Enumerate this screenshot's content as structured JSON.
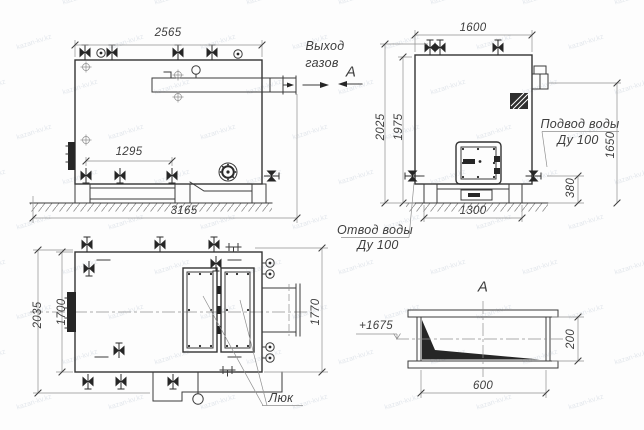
{
  "watermark": {
    "text": "kazan-kv.kz"
  },
  "front_view": {
    "dim_top_width": "2565",
    "dim_drain_spacing": "1295",
    "dim_total_length": "3165",
    "gas_outlet_line1": "Выход",
    "gas_outlet_line2": "газов",
    "section_mark": "А"
  },
  "side_view": {
    "dim_top_width": "1600",
    "dim_total_height": "2025",
    "dim_shell_height": "1975",
    "dim_gas_outlet_height": "1650",
    "dim_water_inlet_height": "380",
    "dim_base_width": "1300",
    "water_inlet_line1": "Подвод воды",
    "water_inlet_line2": "Ду 100",
    "water_outlet_line1": "Отвод воды",
    "water_outlet_line2": "Ду 100"
  },
  "plan_view": {
    "dim_total_width": "2035",
    "dim_shell_width": "1700",
    "dim_right_width": "1770",
    "hatch_label": "Люк"
  },
  "section_view": {
    "title": "А",
    "elevation_mark": "+1675",
    "dim_height": "200",
    "dim_width": "600"
  }
}
